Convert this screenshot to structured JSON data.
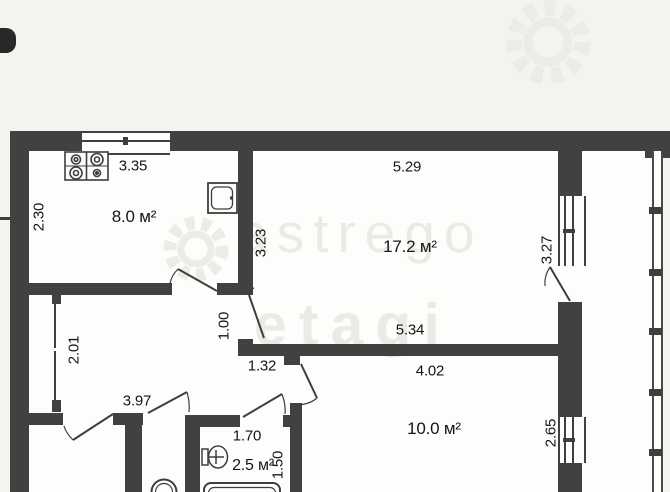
{
  "plan_type": "apartment-floor-plan",
  "colors": {
    "page_bg": "#f3f3f0",
    "room_bg": "#fdfdfb",
    "wall": "#414141",
    "line": "#3e3e3e",
    "text": "#161616",
    "watermark": "#ebebe6"
  },
  "watermark": {
    "word_top": "astrego",
    "word_bottom": "etagi",
    "gear_icon": "gear"
  },
  "rooms": {
    "kitchen": "8.0 м²",
    "living": "17.2 м²",
    "bedroom": "10.0 м²",
    "bathroom": "2.5 м²"
  },
  "dims": {
    "kitchen_w": "3.35",
    "kitchen_h": "2.30",
    "living_w_top": "5.29",
    "living_h_left": "3.23",
    "living_h_right": "3.27",
    "living_w_bottom": "5.34",
    "hall_opening": "1.00",
    "closet_h": "2.01",
    "hall_w": "3.97",
    "vestibule_w": "1.32",
    "bedroom_w": "4.02",
    "bedroom_h": "2.65",
    "bath_w": "1.70",
    "bath_h": "1.50"
  }
}
